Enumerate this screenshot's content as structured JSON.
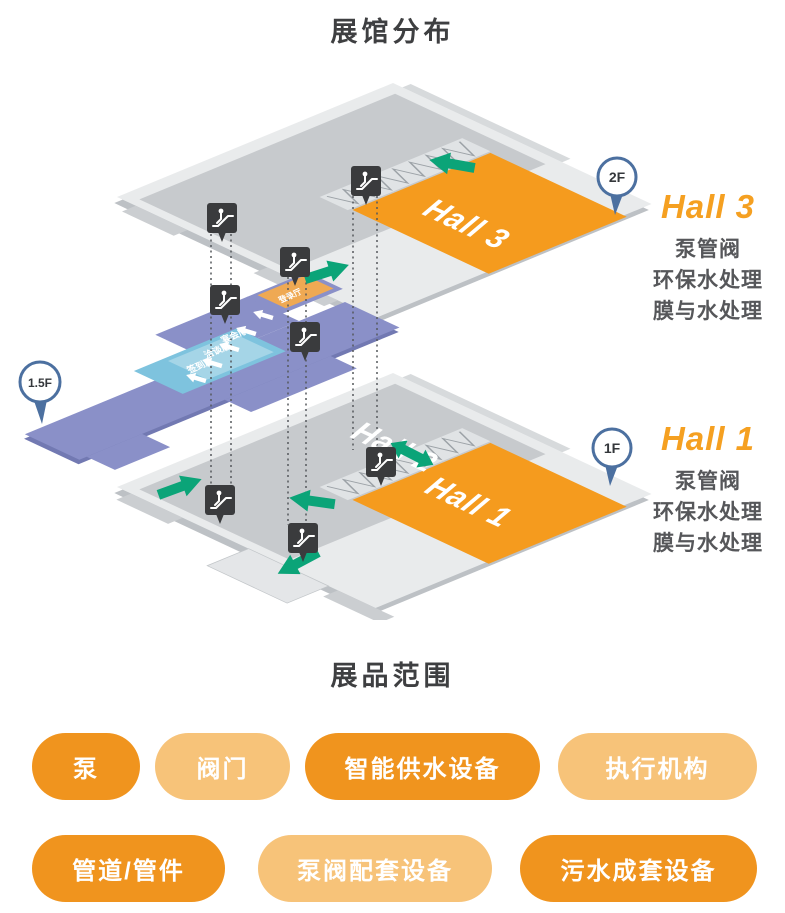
{
  "header": {
    "title": "展馆分布"
  },
  "diagram": {
    "pins": {
      "f2": "2F",
      "f15": "1.5F",
      "f1": "1F"
    },
    "floor2": {
      "hall": "Hall 3"
    },
    "floor1": {
      "hall": "Hall 1",
      "hall2": "Hall 2"
    },
    "mezzanine": {
      "rooms": [
        "宴会厅",
        "洽谈厅",
        "签到厅"
      ],
      "strip": "登录厅"
    },
    "legends": [
      {
        "title": "Hall 3",
        "lines": [
          "泵管阀",
          "环保水处理",
          "膜与水处理"
        ]
      },
      {
        "title": "Hall 1",
        "lines": [
          "泵管阀",
          "环保水处理",
          "膜与水处理"
        ]
      }
    ],
    "icons": [
      "escalator-icon",
      "location-pin-icon",
      "direction-arrow-icon"
    ]
  },
  "products": {
    "title": "展品范围",
    "row1": [
      {
        "label": "泵",
        "tone": "dark"
      },
      {
        "label": "阀门",
        "tone": "light"
      },
      {
        "label": "智能供水设备",
        "tone": "dark"
      },
      {
        "label": "执行机构",
        "tone": "light"
      }
    ],
    "row2": [
      {
        "label": "管道/管件",
        "tone": "dark"
      },
      {
        "label": "泵阀配套设备",
        "tone": "light"
      },
      {
        "label": "污水成套设备",
        "tone": "dark"
      }
    ]
  },
  "colors": {
    "accent_dark": "#F0941E",
    "accent_light": "#F7C379",
    "hall_orange": "#F59B1E",
    "legend_orange": "#F5A021",
    "arrow_green": "#0BA478",
    "walkway_purple": "#8A90C8",
    "room_blue": "#7EC3DE",
    "pin_blue": "#4C70A0",
    "badge_dark": "#3A3B3D"
  }
}
